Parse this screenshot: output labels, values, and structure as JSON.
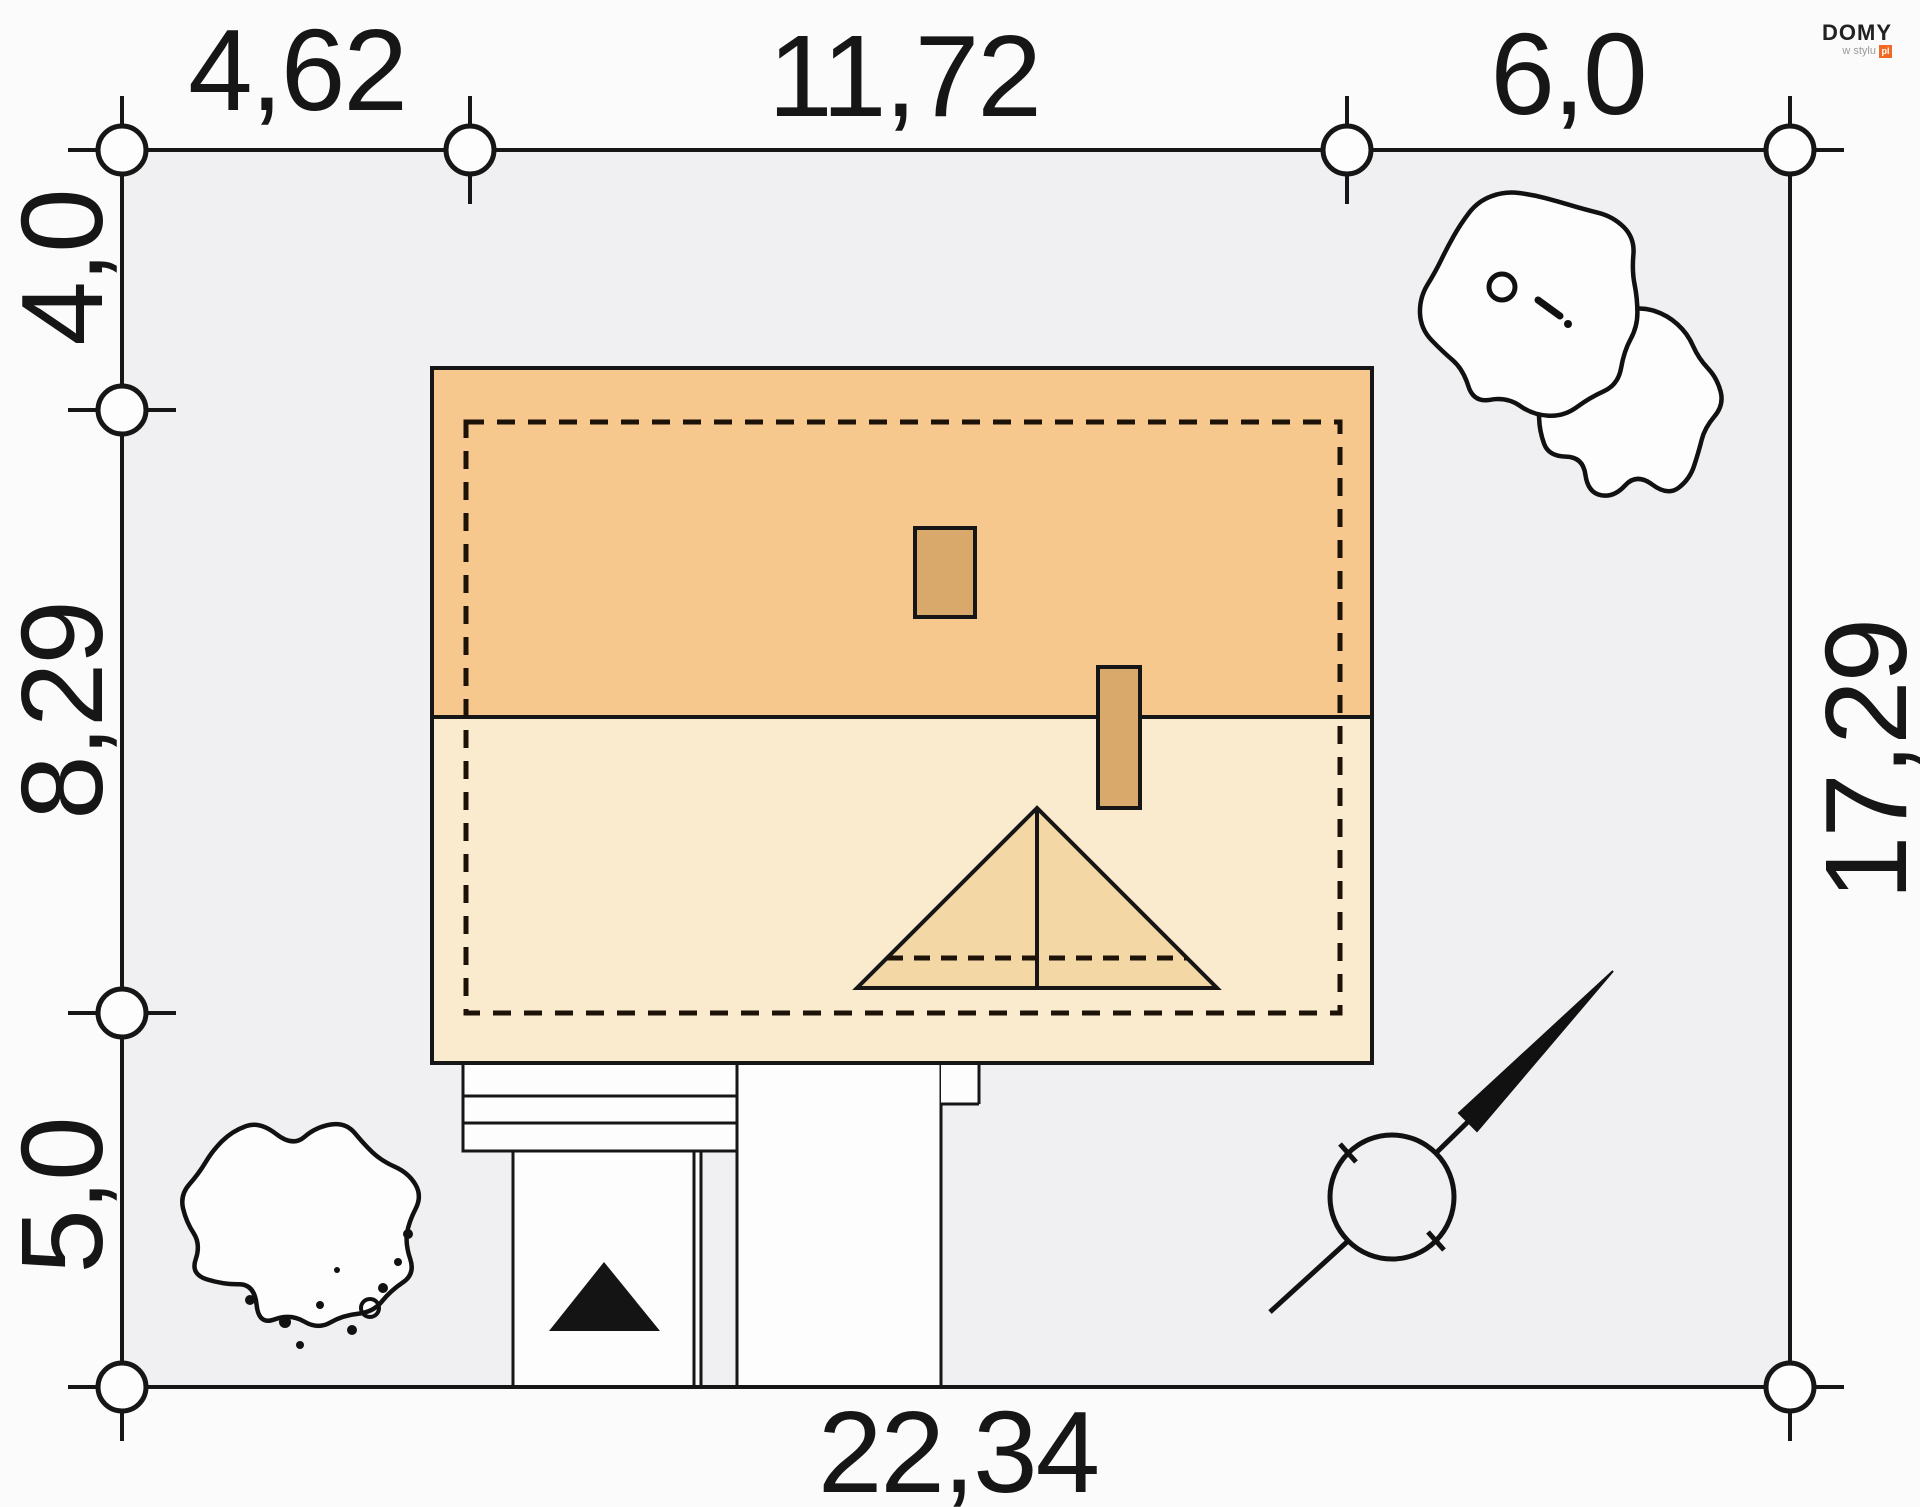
{
  "branding": {
    "name": "DOMY",
    "tagline": "w stylu",
    "badge": "pl",
    "accent_color": "#F26A21"
  },
  "site_plan": {
    "dimensions_m": {
      "top": [
        "4,62",
        "11,72",
        "6,0"
      ],
      "left": [
        "4,0",
        "8,29",
        "5,0"
      ],
      "right": [
        "17,29"
      ],
      "bottom": [
        "22,34"
      ]
    },
    "colors": {
      "plot_fill": "#F0EFF1",
      "line": "#161616",
      "roof_upper": "#F6C88E",
      "roof_lower": "#FBEBCE",
      "dormer_fill": "#F3D8A6",
      "chimney_fill": "#D9A96B",
      "paving_fill": "#FDFDFD"
    },
    "icons": {
      "survey_marker": "survey-point-circle",
      "north": "north-arrow",
      "entrance": "entrance-arrow-triangle",
      "vegetation": "deciduous-tree"
    }
  }
}
